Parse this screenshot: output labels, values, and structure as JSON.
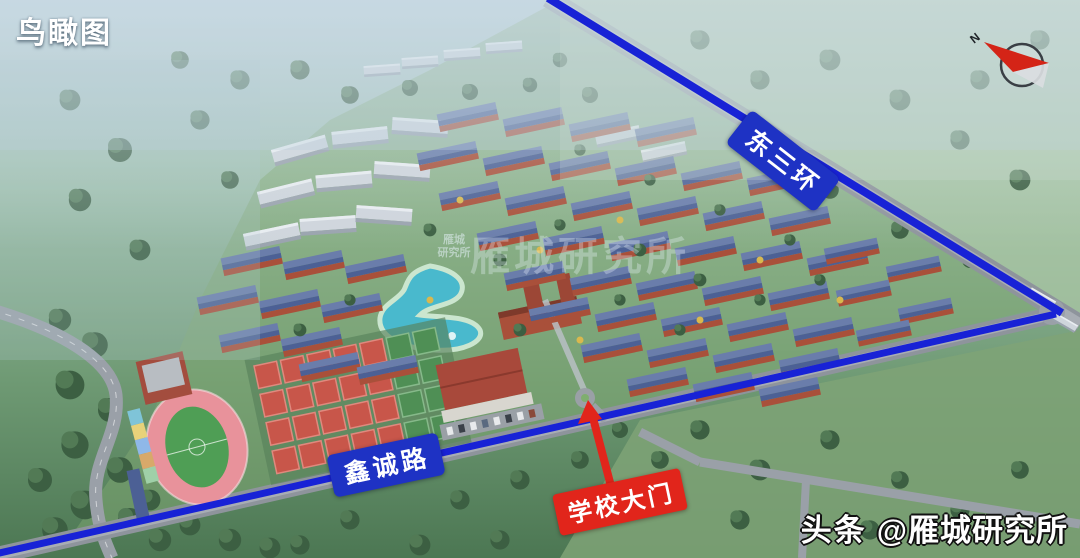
{
  "page": {
    "title": "鸟瞰图"
  },
  "overlay": {
    "view_title": "鸟瞰图",
    "compass_n": "N",
    "watermark_small": {
      "line1": "雁城",
      "line2": "研究所"
    },
    "watermark_large": "雁城研究所",
    "credit": {
      "brand": "头条",
      "handle": "@雁城研究所"
    }
  },
  "map": {
    "roads": {
      "east_third_ring": "东三环",
      "xincheng_road": "鑫诚路"
    },
    "annotations": {
      "school_gate": "学校大门"
    }
  },
  "colors": {
    "road_highlight": "#1822d6",
    "road_label_bg": "#1e32c4",
    "gate_label_bg": "#e1251b",
    "label_text": "#ffffff",
    "roof_blue": "#4c6095",
    "roof_blue_light": "#6a7dab",
    "brick_wall": "#a9503a",
    "lake": "#49b9cd",
    "track": "#e8929b",
    "pitch": "#4f9e55",
    "compass_needle": "#d42417"
  }
}
